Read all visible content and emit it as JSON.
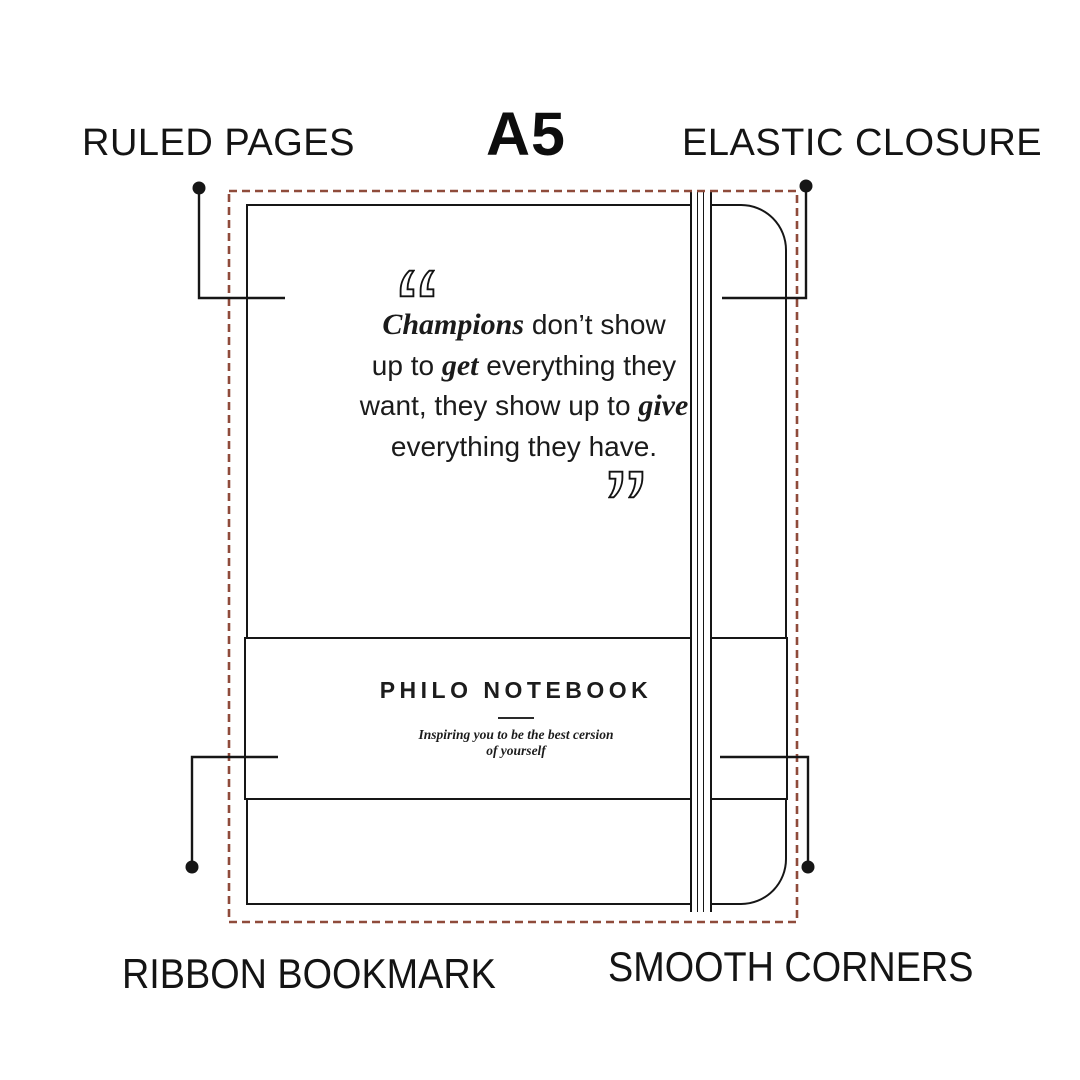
{
  "size_label": "A5",
  "features": {
    "ruled_pages": "RULED PAGES",
    "elastic_closure": "ELASTIC CLOSURE",
    "ribbon_bookmark": "RIBBON BOOKMARK",
    "smooth_corners": "SMOOTH CORNERS"
  },
  "quote": {
    "l1_italic": "Champions",
    "l1_rest": " don’t show",
    "l2_a": "up to ",
    "l2_italic": "get",
    "l2_b": " everything they",
    "l3_a": "want, they show up to ",
    "l3_italic": "give",
    "l4": "everything they have."
  },
  "brand": {
    "name": "PHILO NOTEBOOK",
    "tagline_line1": "Inspiring you to be the best cersion",
    "tagline_line2": "of yourself"
  },
  "colors": {
    "dash_border": "#8f4b3b",
    "line": "#161616"
  }
}
